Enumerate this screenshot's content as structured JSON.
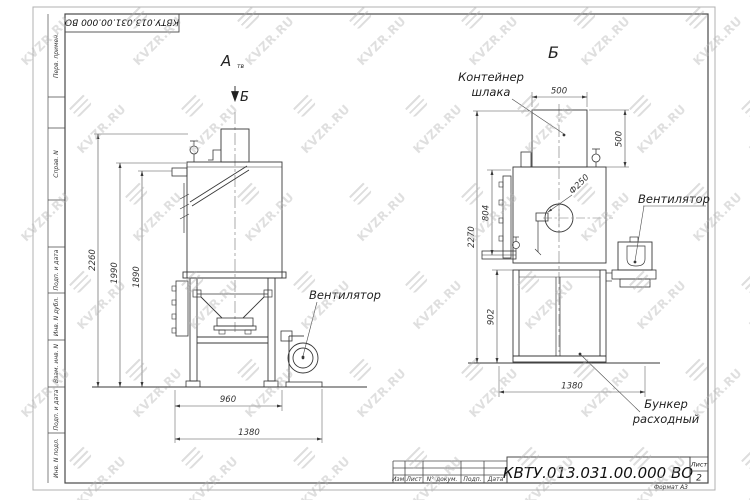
{
  "watermark": {
    "text": "KVZR.RU"
  },
  "frame": {
    "doc_number_rotated": "КВТУ.013.031.00.000  ВО",
    "stamp_fields": [
      "Перв. примен.",
      "Справ. N",
      "Подп. и дата",
      "Инв. N дубл.",
      "Взам. инв. N",
      "Подп. и дата",
      "Инв. N подл."
    ]
  },
  "title_block": {
    "doc_number": "КВТУ.013.031.00.000  ВО",
    "sheet_label": "Лист",
    "sheet_number": "2",
    "format_note": "Формат А3",
    "rev_cols": [
      "Изм.",
      "Лист",
      "N° докум.",
      "Подп.",
      "Дата"
    ]
  },
  "view_a": {
    "title": "А",
    "title_sub": "тв",
    "section_label": "Б",
    "fan_label": "Вентилятор",
    "dim_height_total": "2260",
    "dim_height_body": "1990",
    "dim_height_inner": "1890",
    "dim_width_frame": "960",
    "dim_width_total": "1380"
  },
  "view_b": {
    "title": "Б",
    "container_label_line1": "Контейнер",
    "container_label_line2": "шлака",
    "fan_label": "Вентилятор",
    "hopper_label_line1": "Бункер",
    "hopper_label_line2": "расходный",
    "dim_container_width": "500",
    "dim_container_height": "500",
    "dim_height_total": "2270",
    "dim_body_upper": "804",
    "dim_frame_height": "902",
    "dim_width_total": "1380",
    "dim_flue_diameter": "Ф250"
  }
}
